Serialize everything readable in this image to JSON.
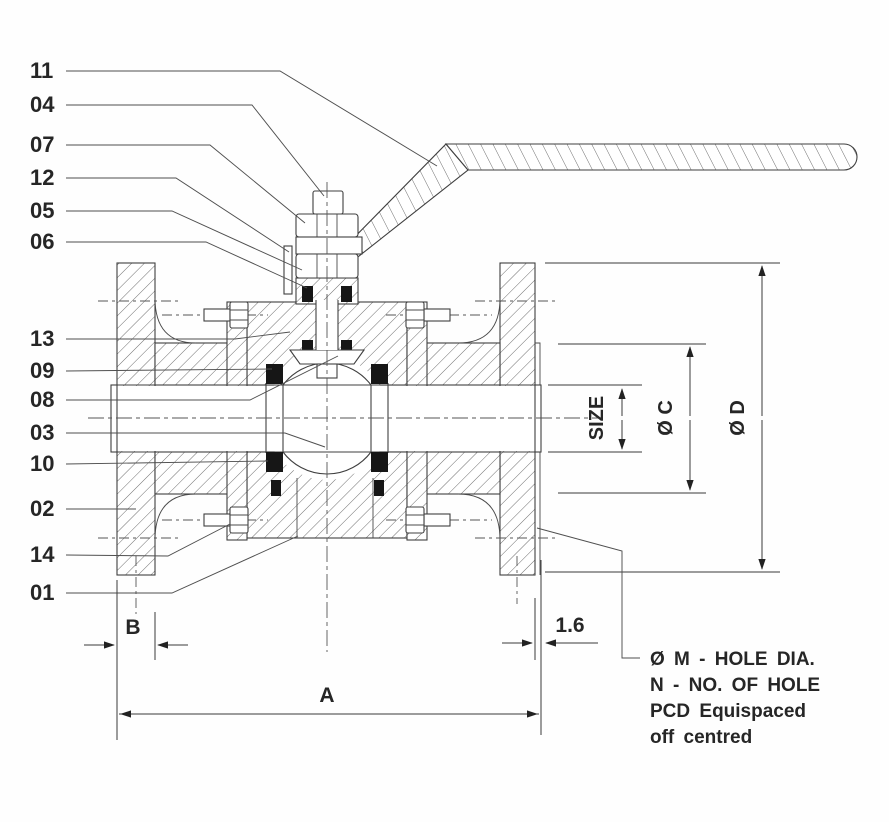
{
  "drawing": {
    "part_labels": [
      "11",
      "04",
      "07",
      "12",
      "05",
      "06",
      "13",
      "09",
      "08",
      "03",
      "10",
      "02",
      "14",
      "01"
    ],
    "dimensions": {
      "b_label": "B",
      "a_label": "A",
      "raised_face_label": "1.6",
      "size_label": "SIZE",
      "c_label": "Ø C",
      "d_label": "Ø D"
    },
    "notes": {
      "line1": "Ø M - HOLE DIA.",
      "line2": "N - NO. OF HOLE",
      "line3": "PCD Equispaced",
      "line4": "off centred"
    }
  }
}
